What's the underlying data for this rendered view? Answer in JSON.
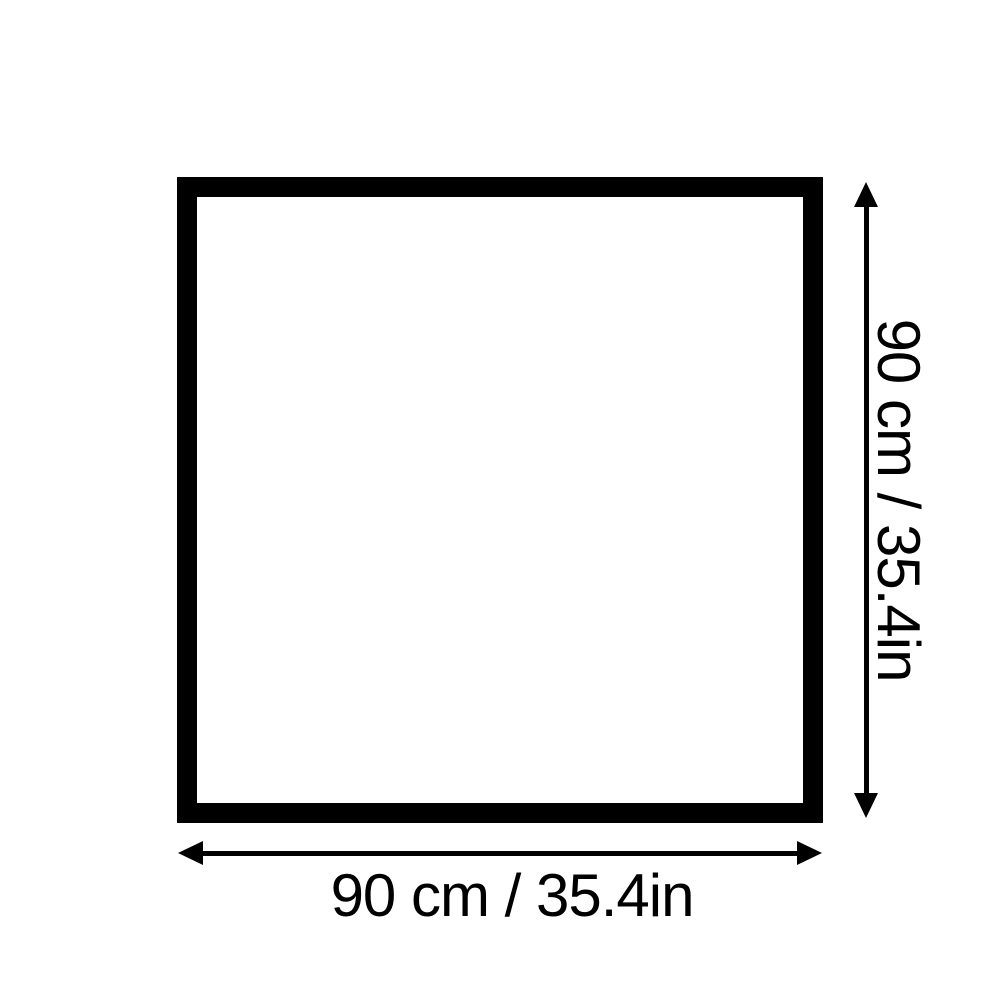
{
  "page": {
    "background_color": "#ffffff"
  },
  "diagram": {
    "type": "product-dimension-diagram",
    "shape": "square",
    "stroke_color": "#000000",
    "width_dimension": {
      "label": "90 cm / 35.4in",
      "arrow": "double-headed-horizontal"
    },
    "height_dimension": {
      "label": "90 cm / 35.4in",
      "arrow": "double-headed-vertical"
    }
  }
}
